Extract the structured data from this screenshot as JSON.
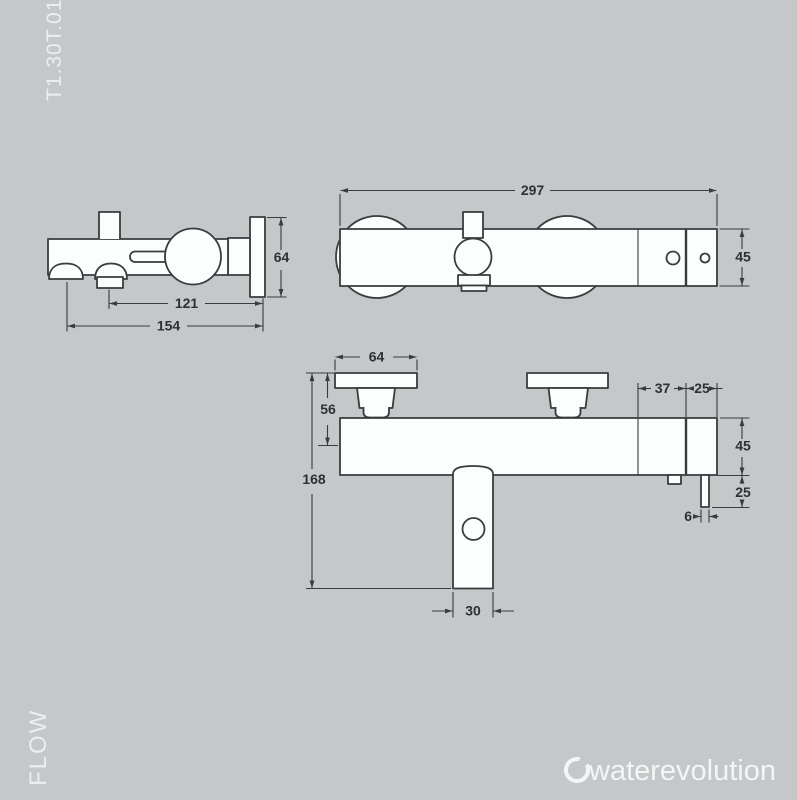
{
  "canvas": {
    "background_color": "#c5c7c9",
    "line_color": "#383c3f",
    "shape_fill_color": "#fcfdfd",
    "dim_text_color": "#2d3134",
    "light_text_color": "#eceef0"
  },
  "margin_labels": {
    "product_code": "T1.30T.01",
    "series_name": "FLOW"
  },
  "brand": {
    "logo_text": "waterevolution"
  },
  "views": {
    "side_view": {
      "dims": {
        "plate_height": "64",
        "spout_axis_to_wall": "121",
        "handshower_axis_to_wall": "154"
      }
    },
    "top_view": {
      "dims": {
        "total_width": "297",
        "body_depth": "45"
      }
    },
    "front_view": {
      "dims": {
        "escutcheon_width": "64",
        "plate_top_to_body_axis": "56",
        "total_height": "168",
        "spout_width": "30",
        "segment_37": "37",
        "segment_25": "25",
        "body_height": "45",
        "outlet_drop": "25",
        "outlet_width": "6"
      }
    }
  }
}
